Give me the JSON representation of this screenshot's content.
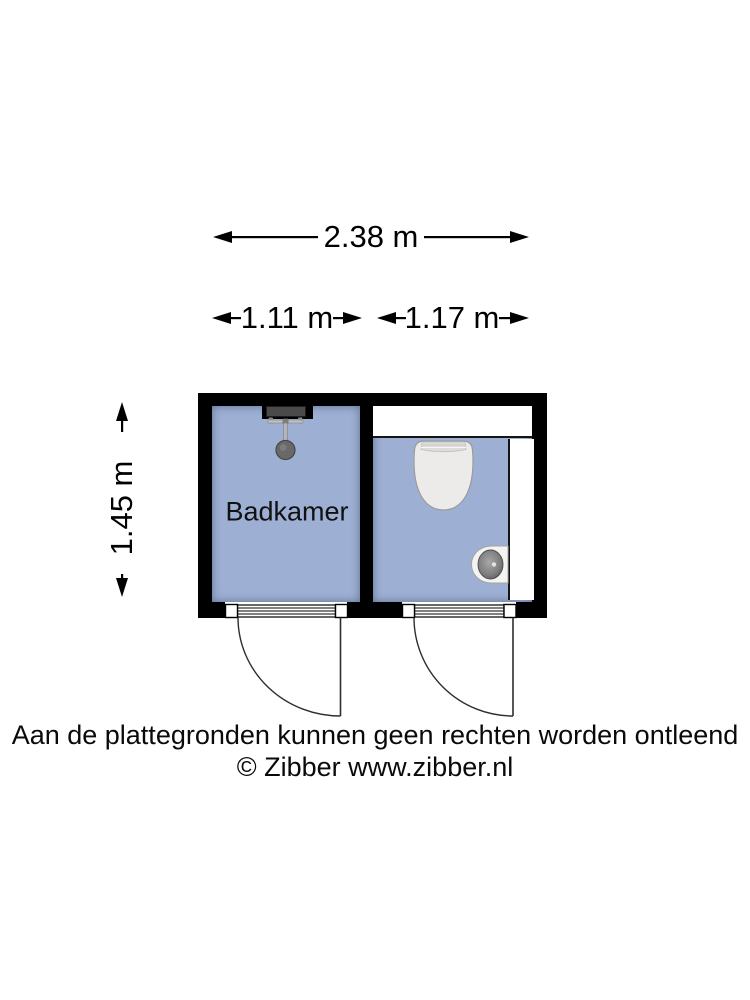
{
  "plan": {
    "room_label": "Badkamer",
    "dimensions": {
      "total_width": "2.38 m",
      "bathroom_width": "1.11 m",
      "toilet_width": "1.17 m",
      "depth": "1.45 m"
    },
    "fixtures": {
      "shower": "shower-head-icon",
      "toilet": "toilet-icon",
      "sink": "hand-basin-icon"
    }
  },
  "footer": {
    "disclaimer": "Aan de plattegronden kunnen geen rechten worden ontleend",
    "copyright": "© Zibber www.zibber.nl"
  },
  "colors": {
    "floor": "#9db0d3",
    "wall": "#000000",
    "text": "#000000",
    "fixture": "#ebebe9"
  }
}
